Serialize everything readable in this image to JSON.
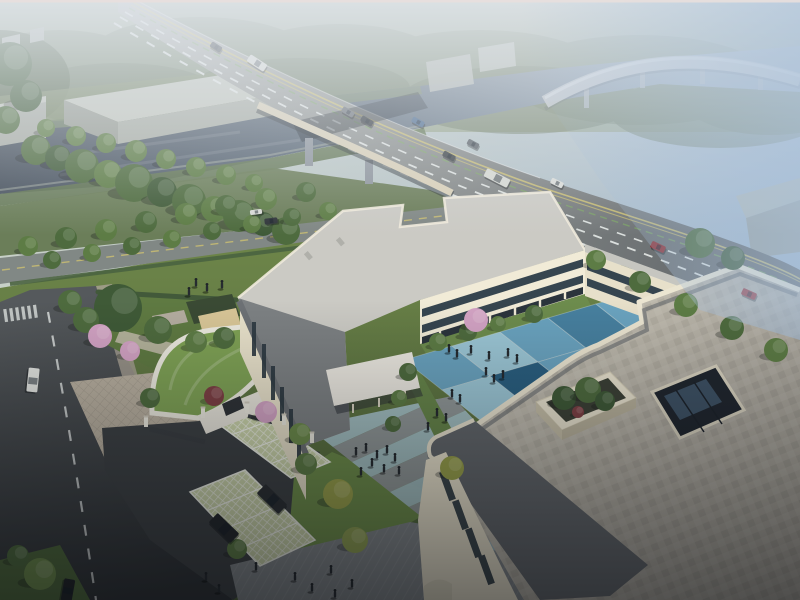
{
  "meta": {
    "title": "Aerial architectural rendering",
    "description": "Bird's-eye dusk rendering of a cream three-storey E-shaped campus building with a blue checkerboard courtyard, curved green-roof gatehouse, grass-grid parking with two black SUVs, landscaped gardens with pink blossom trees, a dark canal crossed by a multi-lane road bridge with traffic, an elevated viaduct and misty woodland beyond."
  },
  "palette": {
    "facade_cream": "#ece6d2",
    "roof_light": "#cbcac4",
    "roof_dark": "#63676b",
    "roof_pavers": "#bdb8ab",
    "water": "#46505c",
    "grass": "#6d8549",
    "green_roof": "#7fa255",
    "asphalt": "#3d4144",
    "blossom_pink": "#d3a3c4",
    "red_car": "#8e3236",
    "courtyard_blues": [
      "#9cc7d6",
      "#6aa3bf",
      "#47809f",
      "#2a5f80",
      "#1d4966",
      "#84b5c9"
    ]
  },
  "courtyard": {
    "origin": [
      404,
      360
    ],
    "u": [
      48,
      -14
    ],
    "v": [
      38,
      30
    ],
    "joint": "#d5dee2",
    "colors": [
      "#9cc7d6",
      "#6aa3bf",
      "#47809f",
      "#2a5f80",
      "#1d4966",
      "#84b5c9"
    ],
    "tiles": [
      [
        0,
        0,
        1
      ],
      [
        1,
        0,
        0
      ],
      [
        2,
        0,
        1
      ],
      [
        3,
        0,
        2
      ],
      [
        4,
        0,
        1
      ],
      [
        0,
        1,
        0
      ],
      [
        1,
        1,
        3
      ],
      [
        2,
        1,
        1
      ],
      [
        3,
        1,
        1
      ],
      [
        4,
        1,
        4
      ],
      [
        0,
        2,
        2
      ],
      [
        1,
        2,
        1
      ],
      [
        2,
        2,
        4
      ],
      [
        3,
        2,
        2
      ],
      [
        4,
        2,
        1
      ],
      [
        0,
        3,
        1
      ],
      [
        1,
        3,
        2
      ],
      [
        2,
        3,
        1
      ],
      [
        3,
        3,
        3
      ],
      [
        4,
        3,
        0
      ]
    ]
  },
  "trees": {
    "colors": [
      "#3f5a37",
      "#4e6b3e",
      "#5d7c45",
      "#6d8c4b",
      "#9aa24b",
      "#d3a3c4",
      "#7e4044",
      "#8fa052"
    ],
    "back": [
      [
        36,
        150,
        15,
        1
      ],
      [
        58,
        158,
        13,
        0
      ],
      [
        82,
        166,
        17,
        1
      ],
      [
        108,
        174,
        14,
        2
      ],
      [
        134,
        183,
        19,
        1
      ],
      [
        162,
        192,
        15,
        0
      ],
      [
        189,
        201,
        17,
        1
      ],
      [
        214,
        209,
        13,
        2
      ],
      [
        239,
        216,
        16,
        1
      ],
      [
        263,
        224,
        12,
        0
      ],
      [
        286,
        231,
        14,
        1
      ],
      [
        46,
        128,
        9,
        2
      ],
      [
        76,
        136,
        10,
        2
      ],
      [
        106,
        143,
        10,
        2
      ],
      [
        136,
        151,
        11,
        2
      ],
      [
        166,
        159,
        10,
        2
      ],
      [
        196,
        167,
        10,
        2
      ],
      [
        226,
        175,
        10,
        2
      ],
      [
        254,
        183,
        9,
        2
      ],
      [
        28,
        246,
        10,
        2
      ],
      [
        66,
        238,
        11,
        1
      ],
      [
        106,
        230,
        11,
        2
      ],
      [
        146,
        222,
        11,
        1
      ],
      [
        186,
        214,
        11,
        2
      ],
      [
        226,
        206,
        11,
        1
      ],
      [
        266,
        199,
        11,
        2
      ],
      [
        306,
        192,
        10,
        1
      ],
      [
        52,
        260,
        9,
        1
      ],
      [
        92,
        253,
        9,
        2
      ],
      [
        132,
        246,
        9,
        1
      ],
      [
        172,
        239,
        9,
        2
      ],
      [
        212,
        231,
        9,
        1
      ],
      [
        252,
        224,
        9,
        2
      ],
      [
        292,
        217,
        9,
        1
      ],
      [
        328,
        211,
        9,
        2
      ],
      [
        480,
        214,
        13,
        1
      ],
      [
        524,
        234,
        14,
        0
      ],
      [
        572,
        256,
        13,
        1
      ],
      [
        622,
        279,
        14,
        0
      ],
      [
        670,
        301,
        13,
        1
      ],
      [
        718,
        324,
        15,
        0
      ],
      [
        764,
        347,
        13,
        1
      ],
      [
        795,
        362,
        12,
        0
      ],
      [
        118,
        308,
        24,
        0
      ],
      [
        86,
        320,
        13,
        1
      ],
      [
        158,
        330,
        14,
        1
      ],
      [
        196,
        342,
        11,
        2
      ],
      [
        224,
        338,
        11,
        1
      ],
      [
        100,
        336,
        12,
        5
      ],
      [
        130,
        351,
        10,
        5
      ],
      [
        70,
        302,
        12,
        1
      ],
      [
        360,
        250,
        9,
        2
      ],
      [
        10,
        64,
        22,
        0
      ],
      [
        26,
        96,
        16,
        0
      ],
      [
        6,
        120,
        14,
        1
      ],
      [
        40,
        574,
        16,
        3
      ],
      [
        18,
        556,
        11,
        1
      ]
    ],
    "front": [
      [
        438,
        342,
        9,
        2
      ],
      [
        468,
        332,
        9,
        1
      ],
      [
        498,
        324,
        8,
        2
      ],
      [
        534,
        314,
        9,
        1
      ],
      [
        476,
        320,
        12,
        5
      ],
      [
        408,
        372,
        9,
        1
      ],
      [
        399,
        398,
        8,
        2
      ],
      [
        393,
        424,
        8,
        1
      ],
      [
        338,
        494,
        15,
        4
      ],
      [
        306,
        464,
        11,
        2
      ],
      [
        355,
        540,
        13,
        7
      ],
      [
        237,
        549,
        10,
        2
      ],
      [
        452,
        468,
        12,
        4
      ],
      [
        300,
        434,
        11,
        3
      ],
      [
        596,
        260,
        10,
        2
      ],
      [
        640,
        282,
        11,
        1
      ],
      [
        686,
        305,
        12,
        2
      ],
      [
        732,
        328,
        12,
        1
      ],
      [
        776,
        350,
        12,
        2
      ],
      [
        700,
        243,
        15,
        1
      ],
      [
        733,
        258,
        12,
        0
      ],
      [
        564,
        398,
        12,
        0
      ],
      [
        588,
        390,
        13,
        1
      ],
      [
        605,
        401,
        10,
        0
      ],
      [
        578,
        412,
        6,
        6
      ],
      [
        214,
        396,
        10,
        6
      ],
      [
        266,
        412,
        11,
        5
      ],
      [
        150,
        398,
        10,
        1
      ]
    ]
  },
  "vehicles": [
    {
      "name": "bus",
      "x": 257,
      "y": 63,
      "l": 20,
      "w": 8,
      "rot": 33,
      "c": "#d9dbd5"
    },
    {
      "name": "car",
      "x": 216,
      "y": 47,
      "l": 12,
      "w": 6,
      "rot": 33,
      "c": "#3c4246"
    },
    {
      "name": "car",
      "x": 348,
      "y": 112,
      "l": 13,
      "w": 6,
      "rot": 30,
      "c": "#6a7076"
    },
    {
      "name": "car",
      "x": 367,
      "y": 121,
      "l": 13,
      "w": 6,
      "rot": 30,
      "c": "#343a40"
    },
    {
      "name": "car",
      "x": 418,
      "y": 122,
      "l": 13,
      "w": 6,
      "rot": 28,
      "c": "#48688c"
    },
    {
      "name": "car",
      "x": 449,
      "y": 156,
      "l": 13,
      "w": 6,
      "rot": 28,
      "c": "#3a4044"
    },
    {
      "name": "car",
      "x": 473,
      "y": 144,
      "l": 12,
      "w": 6,
      "rot": 28,
      "c": "#596066"
    },
    {
      "name": "bus",
      "x": 497,
      "y": 178,
      "l": 26,
      "w": 9,
      "rot": 27,
      "c": "#d6d8d2"
    },
    {
      "name": "car",
      "x": 557,
      "y": 183,
      "l": 13,
      "w": 6,
      "rot": 26,
      "c": "#dadcd8"
    },
    {
      "name": "car",
      "x": 658,
      "y": 247,
      "l": 15,
      "w": 7,
      "rot": 25,
      "c": "#8e3236"
    },
    {
      "name": "car",
      "x": 749,
      "y": 294,
      "l": 15,
      "w": 7,
      "rot": 24,
      "c": "#973a3e"
    },
    {
      "name": "car",
      "x": 256,
      "y": 212,
      "l": 12,
      "w": 5,
      "rot": -7,
      "c": "#d8dad6"
    },
    {
      "name": "car",
      "x": 271,
      "y": 221,
      "l": 13,
      "w": 6,
      "rot": -7,
      "c": "#30353a"
    },
    {
      "name": "van",
      "x": 33,
      "y": 380,
      "l": 24,
      "w": 11,
      "rot": 96,
      "c": "#e2e4e0"
    },
    {
      "name": "car",
      "x": 68,
      "y": 590,
      "l": 22,
      "w": 11,
      "rot": 100,
      "c": "#202428"
    },
    {
      "name": "suv",
      "x": 272,
      "y": 499,
      "l": 30,
      "w": 13,
      "rot": 44,
      "c": "#2b2f33"
    },
    {
      "name": "suv",
      "x": 224,
      "y": 528,
      "l": 30,
      "w": 13,
      "rot": 44,
      "c": "#24282c"
    }
  ],
  "people": {
    "courtyard": [
      [
        449,
        349
      ],
      [
        457,
        354
      ],
      [
        471,
        350
      ],
      [
        489,
        356
      ],
      [
        508,
        353
      ],
      [
        517,
        359
      ],
      [
        486,
        372
      ],
      [
        494,
        379
      ],
      [
        503,
        375
      ],
      [
        452,
        394
      ],
      [
        460,
        399
      ],
      [
        437,
        413
      ],
      [
        446,
        418
      ],
      [
        428,
        427
      ]
    ],
    "approach": [
      [
        356,
        452
      ],
      [
        366,
        448
      ],
      [
        377,
        455
      ],
      [
        387,
        450
      ],
      [
        395,
        458
      ],
      [
        372,
        463
      ],
      [
        384,
        469
      ],
      [
        399,
        471
      ],
      [
        361,
        472
      ]
    ],
    "plaza": [
      [
        295,
        577
      ],
      [
        312,
        588
      ],
      [
        331,
        570
      ],
      [
        206,
        577
      ],
      [
        219,
        589
      ],
      [
        256,
        567
      ],
      [
        352,
        584
      ],
      [
        335,
        594
      ]
    ],
    "north_lawn": [
      [
        196,
        283
      ],
      [
        207,
        288
      ],
      [
        222,
        285
      ],
      [
        189,
        292
      ]
    ]
  },
  "parking": {
    "groups": [
      {
        "quad": [
          [
            213,
            420
          ],
          [
            252,
            406
          ],
          [
            330,
            462
          ],
          [
            291,
            478
          ]
        ],
        "stalls": 4
      },
      {
        "quad": [
          [
            190,
            492
          ],
          [
            245,
            470
          ],
          [
            315,
            540
          ],
          [
            260,
            566
          ]
        ],
        "stalls": 4
      }
    ]
  },
  "gate_posts": [
    [
      146,
      425
    ],
    [
      203,
      416
    ],
    [
      247,
      411
    ],
    [
      284,
      423
    ],
    [
      312,
      441
    ]
  ],
  "approach_stripes": {
    "origin": [
      314,
      432
    ],
    "step": [
      19,
      15
    ],
    "long": [
      132,
      -60
    ],
    "count": 8,
    "colors": [
      "#a9c6cc",
      "#969ba0"
    ]
  }
}
